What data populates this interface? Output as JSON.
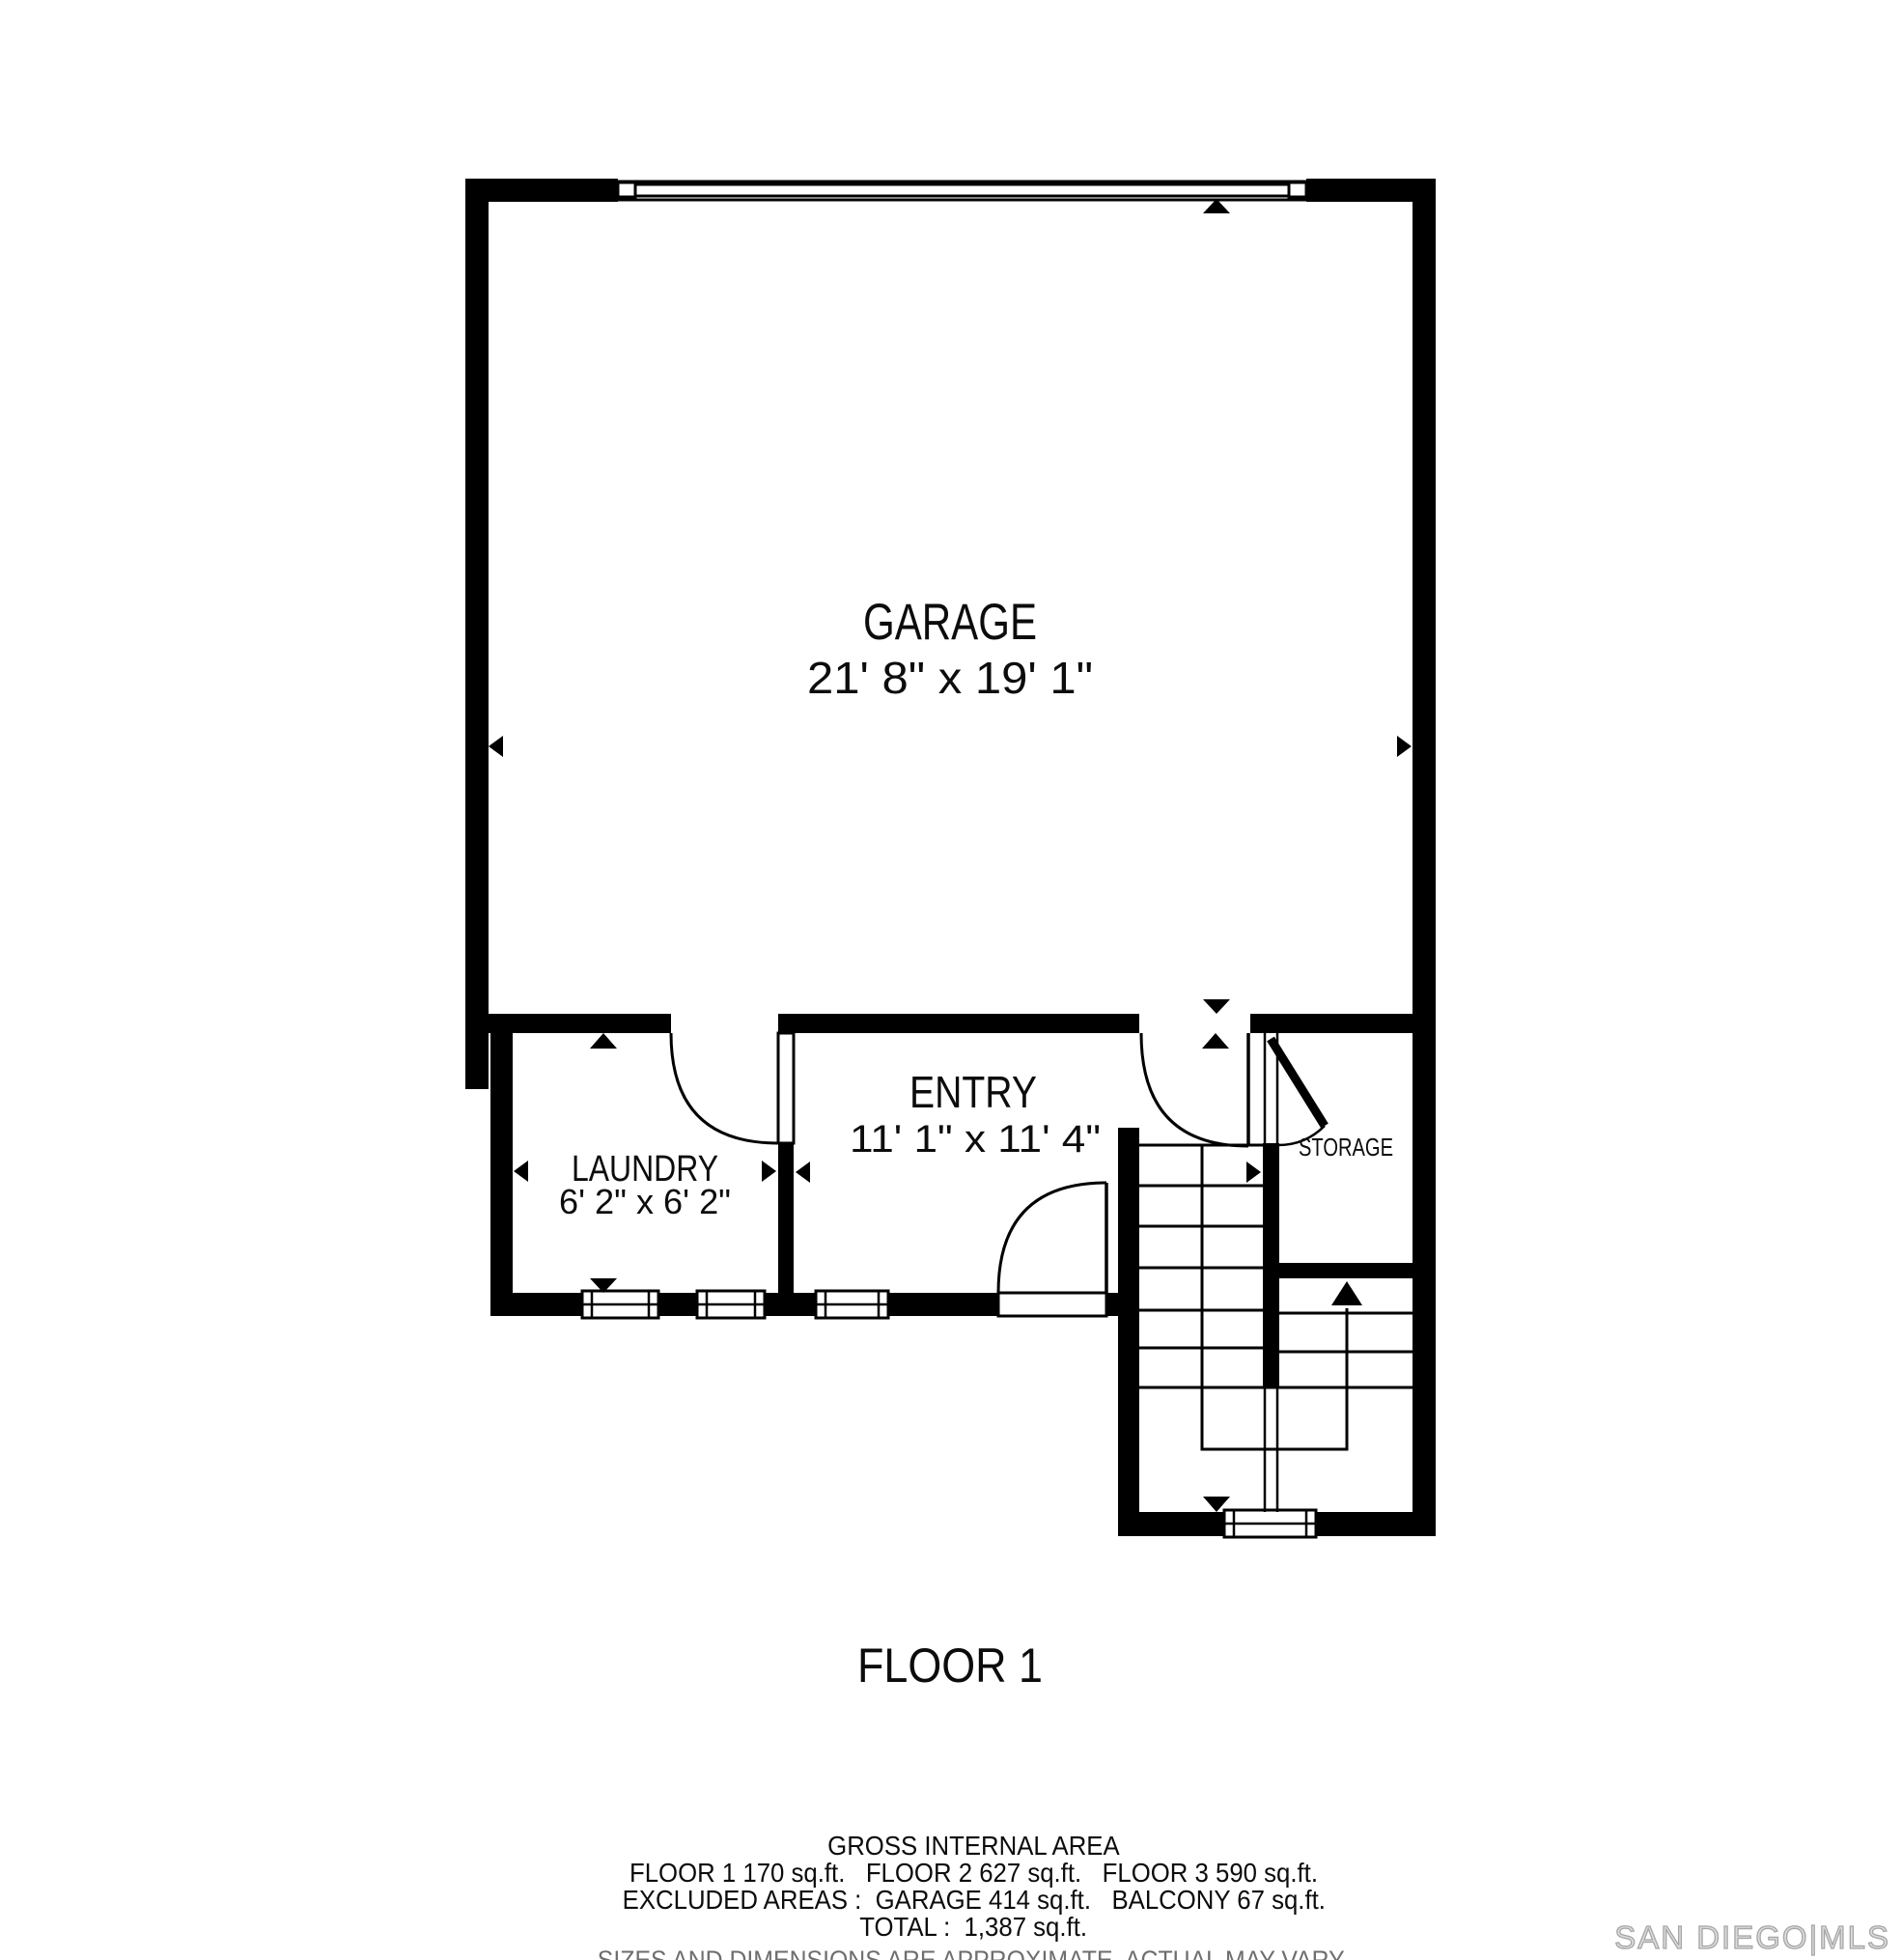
{
  "title": "FLOOR 1",
  "rooms": {
    "garage": {
      "name": "GARAGE",
      "dims": "21' 8\" x 19' 1\""
    },
    "entry": {
      "name": "ENTRY",
      "dims": "11' 1\" x 11' 4\""
    },
    "laundry": {
      "name": "LAUNDRY",
      "dims": "6' 2\" x 6' 2\""
    },
    "storage": {
      "name": "STORAGE"
    }
  },
  "footer": {
    "gross_title": "GROSS INTERNAL AREA",
    "floors_line": "FLOOR 1 170 sq.ft.   FLOOR 2 627 sq.ft.   FLOOR 3 590 sq.ft.",
    "excluded_line": "EXCLUDED AREAS :  GARAGE 414 sq.ft.   BALCONY 67 sq.ft.",
    "total_line": "TOTAL :  1,387 sq.ft.",
    "disclaimer": "SIZES AND DIMENSIONS ARE APPROXIMATE, ACTUAL MAY VARY."
  },
  "watermark": "SAN DIEGO|MLS",
  "colors": {
    "wall": "#000000",
    "background": "#ffffff",
    "disclaimer_text": "#6e6e6e",
    "watermark_gray": "#a6a6a6"
  }
}
